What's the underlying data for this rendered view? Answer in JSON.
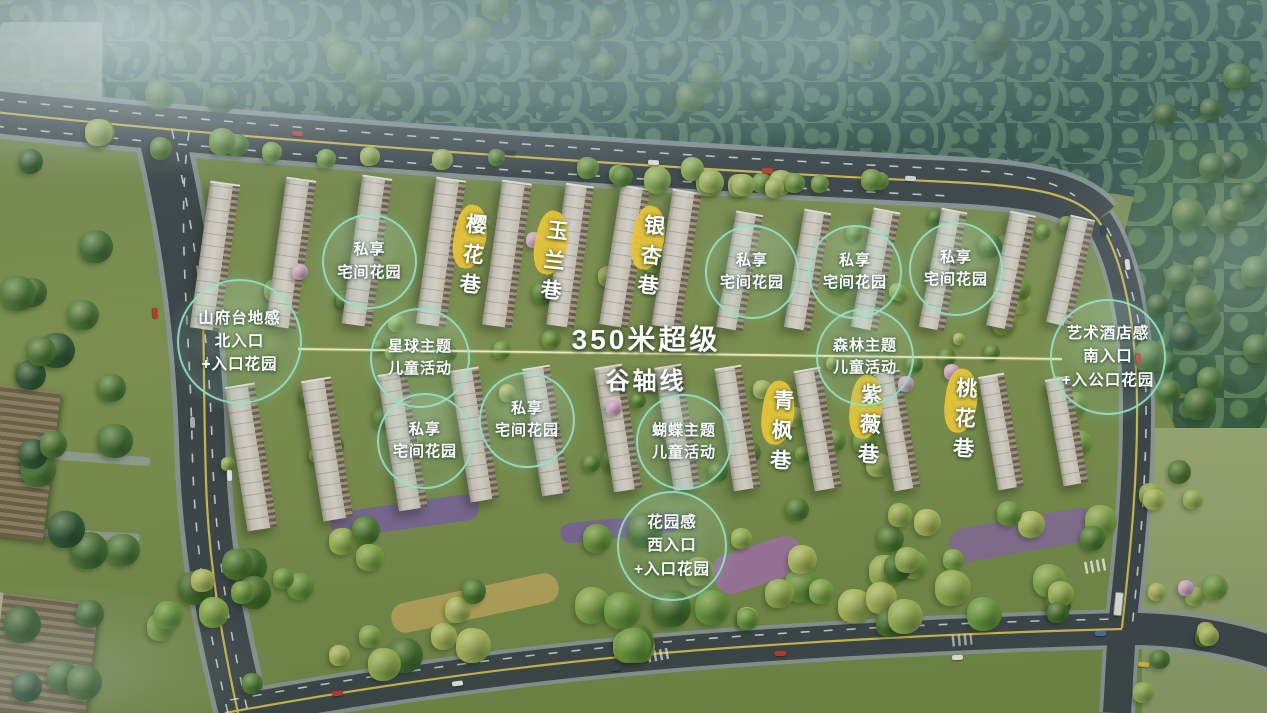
{
  "annotations": {
    "axis": {
      "line1": "350米超级",
      "line2": "谷轴线"
    },
    "badges": [
      {
        "id": "north-entrance",
        "lines": [
          "山府台地感",
          "北入口",
          "+入口花园"
        ]
      },
      {
        "id": "private-garden-1",
        "lines": [
          "私享",
          "宅间花园"
        ]
      },
      {
        "id": "planet-kids",
        "lines": [
          "星球主题",
          "儿童活动"
        ]
      },
      {
        "id": "private-garden-2",
        "lines": [
          "私享",
          "宅间花园"
        ]
      },
      {
        "id": "private-garden-3",
        "lines": [
          "私享",
          "宅间花园"
        ]
      },
      {
        "id": "butterfly-kids",
        "lines": [
          "蝴蝶主题",
          "儿童活动"
        ]
      },
      {
        "id": "private-garden-4",
        "lines": [
          "私享",
          "宅间花园"
        ]
      },
      {
        "id": "private-garden-5",
        "lines": [
          "私享",
          "宅间花园"
        ]
      },
      {
        "id": "forest-kids",
        "lines": [
          "森林主题",
          "儿童活动"
        ]
      },
      {
        "id": "private-garden-6",
        "lines": [
          "私享",
          "宅间花园"
        ]
      },
      {
        "id": "south-entrance",
        "lines": [
          "艺术酒店感",
          "南入口",
          "+入公口花园"
        ]
      },
      {
        "id": "west-entrance",
        "lines": [
          "花园感",
          "西入口",
          "+入口花园"
        ]
      }
    ],
    "lanes": [
      {
        "id": "lane-yinghua",
        "name": "樱花巷"
      },
      {
        "id": "lane-yulan",
        "name": "玉兰巷"
      },
      {
        "id": "lane-yinxing",
        "name": "银杏巷"
      },
      {
        "id": "lane-qingfeng",
        "name": "青枫巷"
      },
      {
        "id": "lane-ziwei",
        "name": "紫薇巷"
      },
      {
        "id": "lane-taohua",
        "name": "桃花巷"
      }
    ]
  },
  "colors": {
    "badge_ring": "#96e1c8",
    "lane_highlight": "#e7c53a",
    "axis_line": "#f2e9b4",
    "label_text": "#ffffff"
  }
}
